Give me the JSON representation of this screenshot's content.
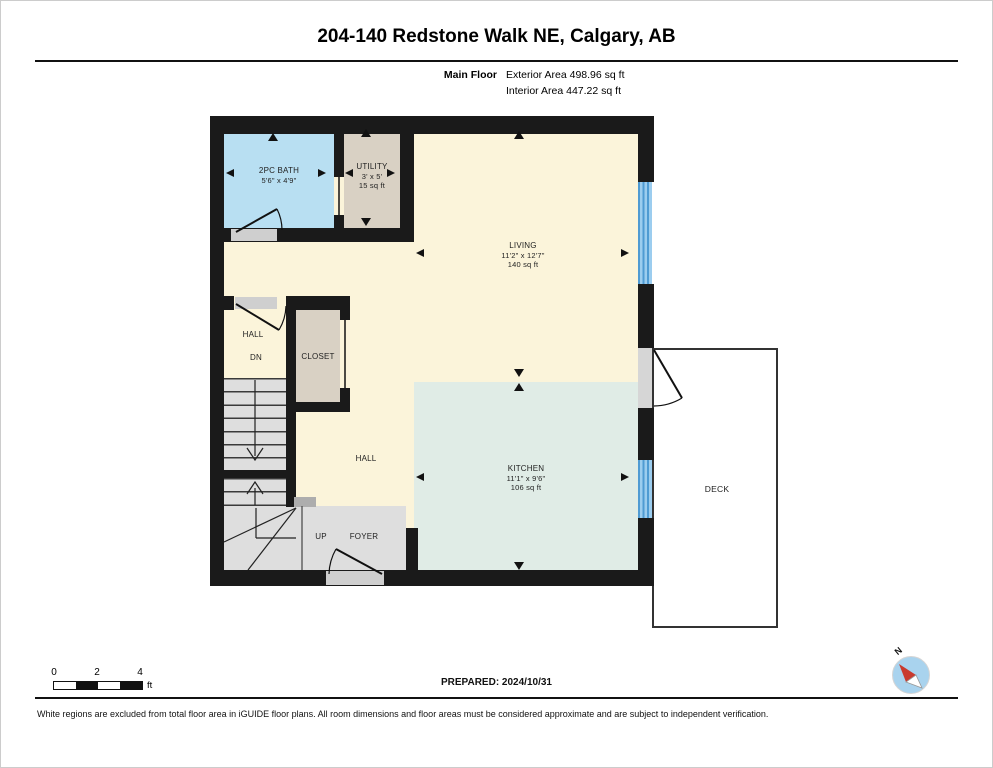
{
  "page": {
    "title": "204-140 Redstone Walk NE, Calgary, AB"
  },
  "floor_info": {
    "floor": "Main Floor",
    "exterior": "Exterior Area 498.96 sq ft",
    "interior": "Interior Area 447.22 sq ft"
  },
  "rooms": {
    "bath": {
      "name": "2PC BATH",
      "dims": "5'6\" x 4'9\""
    },
    "utility": {
      "name": "UTILITY",
      "dims": "3' x 5'",
      "area": "15 sq ft"
    },
    "living": {
      "name": "LIVING",
      "dims": "11'2\" x 12'7\"",
      "area": "140 sq ft"
    },
    "hall_upper": {
      "name": "HALL"
    },
    "stairs_down": {
      "name": "DN"
    },
    "closet": {
      "name": "CLOSET"
    },
    "hall_lower": {
      "name": "HALL"
    },
    "kitchen": {
      "name": "KITCHEN",
      "dims": "11'1\" x 9'6\"",
      "area": "106 sq ft"
    },
    "stairs_up": {
      "name": "UP"
    },
    "foyer": {
      "name": "FOYER"
    },
    "deck": {
      "name": "DECK"
    }
  },
  "scale_bar": {
    "labels": [
      "0",
      "2",
      "4"
    ],
    "unit": "ft"
  },
  "compass": {
    "label": "N"
  },
  "footer": {
    "prepared": "PREPARED: 2024/10/31",
    "disclaimer": "White regions are excluded from total floor area in iGUIDE floor plans. All room dimensions and floor areas must be considered approximate and are subject to independent verification."
  },
  "colors": {
    "wall": "#1a1a1a",
    "bath_fill": "#b8dff2",
    "utility_closet_fill": "#d9d1c4",
    "living_hall_fill": "#fbf4da",
    "kitchen_fill": "#e0ece6",
    "stairs_foyer_fill": "#dedede",
    "window": "#4f9bd3",
    "deck_outline": "#333333",
    "compass_red": "#c93a2e",
    "compass_circle": "#a9d3ee"
  }
}
